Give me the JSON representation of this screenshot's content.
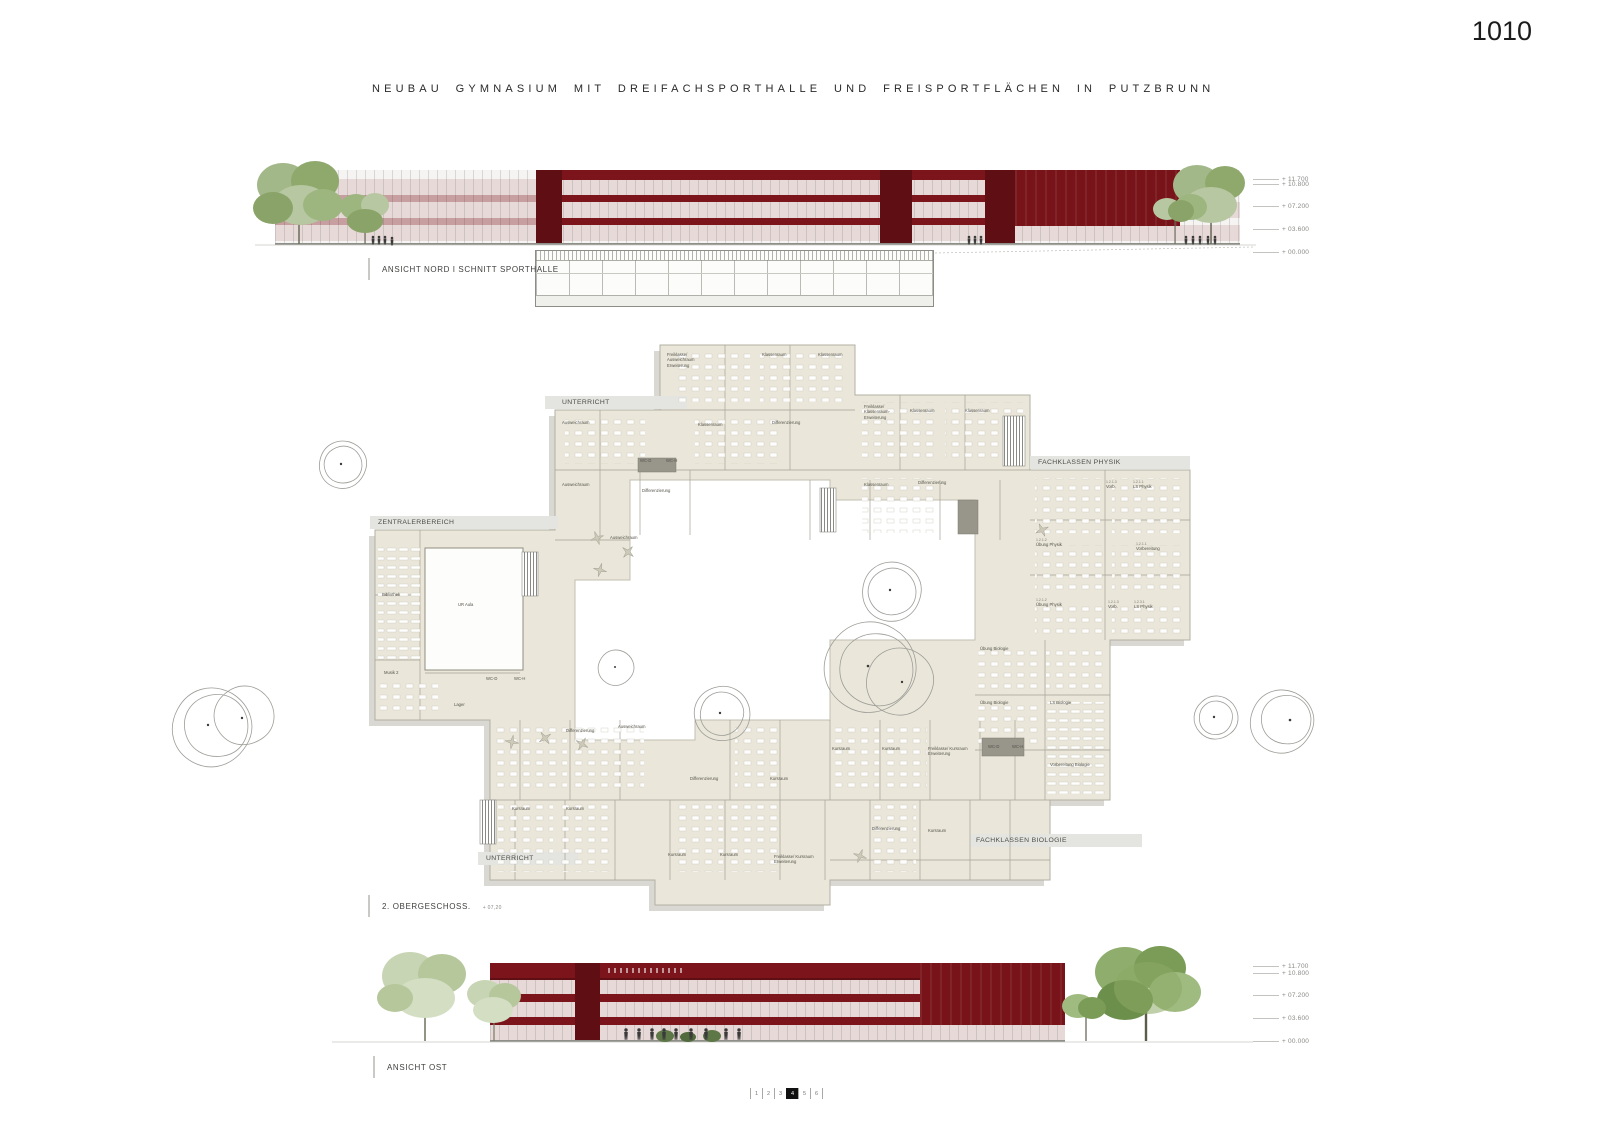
{
  "sheet": {
    "number": "1010"
  },
  "title": "NEUBAU  GYMNASIUM MIT DREIFACHSPORTHALLE UND FREISPORTFLÄCHEN IN PUTZBRUNN",
  "labels": {
    "north": "ANSICHT NORD I SCHNITT SPORTHALLE",
    "east": "ANSICHT OST",
    "floor": "2. OBERGESCHOSS.",
    "floor_level": "+ 07,20"
  },
  "levels": [
    "+ 11.700",
    "+ 10.800",
    "+ 07.200",
    "+ 03.600",
    "+ 00.000"
  ],
  "floor_plan": {
    "zones": [
      {
        "n": "UNTERRICHT",
        "x": 392,
        "y": 69
      },
      {
        "n": "ZENTRALERBEREICH",
        "x": 208,
        "y": 189
      },
      {
        "n": "FACHKLASSEN PHYSIK",
        "x": 868,
        "y": 129
      },
      {
        "n": "FACHKLASSEN BIOLOGIE",
        "x": 806,
        "y": 507
      },
      {
        "n": "UNTERRICHT",
        "x": 316,
        "y": 525
      }
    ],
    "rooms": [
      {
        "n": "Freiklasse/ Ausweichraum Erweiterung",
        "x": 497,
        "y": 22
      },
      {
        "n": "Klassenraum",
        "x": 592,
        "y": 22
      },
      {
        "n": "Klassenraum",
        "x": 648,
        "y": 22
      },
      {
        "n": "Ausweichraum",
        "x": 392,
        "y": 90
      },
      {
        "n": "Klassenraum",
        "x": 528,
        "y": 92
      },
      {
        "n": "Differenzierung",
        "x": 602,
        "y": 90
      },
      {
        "n": "Freiklasse/ Klassenraum-Erweiterung",
        "x": 694,
        "y": 74
      },
      {
        "n": "Klassenraum",
        "x": 740,
        "y": 78
      },
      {
        "n": "Klassenraum",
        "x": 795,
        "y": 78
      },
      {
        "n": "Ausweichraum",
        "x": 392,
        "y": 152
      },
      {
        "n": "WC-D",
        "x": 470,
        "y": 128
      },
      {
        "n": "WC-H",
        "x": 496,
        "y": 128
      },
      {
        "n": "Differenzierung",
        "x": 472,
        "y": 158
      },
      {
        "n": "Klassenraum",
        "x": 694,
        "y": 152
      },
      {
        "n": "Differenzierung",
        "x": 748,
        "y": 150
      },
      {
        "n": "Ausweichraum",
        "x": 440,
        "y": 205
      },
      {
        "c": "1.2.1.3",
        "n": "Vorb.",
        "x": 936,
        "y": 150
      },
      {
        "c": "1.2.1.1",
        "n": "LS Physik",
        "x": 963,
        "y": 150
      },
      {
        "c": "1.2.1.2",
        "n": "Übung Physik",
        "x": 866,
        "y": 208
      },
      {
        "c": "1.2.1.1",
        "n": "Vorbereitung",
        "x": 966,
        "y": 212
      },
      {
        "c": "1.2.1.2",
        "n": "Übung Physik",
        "x": 866,
        "y": 268
      },
      {
        "c": "1.2.1.3",
        "n": "Vorb.",
        "x": 938,
        "y": 270
      },
      {
        "c": "1.2.3.1",
        "n": "LS Physik",
        "x": 964,
        "y": 270
      },
      {
        "n": "Übung Biologie",
        "x": 810,
        "y": 316
      },
      {
        "n": "Übung Biologie",
        "x": 810,
        "y": 370
      },
      {
        "n": "LS Biologie",
        "x": 880,
        "y": 370
      },
      {
        "n": "Vorbereitung Biologie",
        "x": 880,
        "y": 432
      },
      {
        "n": "Bibliothek",
        "x": 212,
        "y": 262
      },
      {
        "n": "UR Aula",
        "x": 288,
        "y": 272
      },
      {
        "n": "Musik 2",
        "x": 214,
        "y": 340
      },
      {
        "n": "Lager",
        "x": 284,
        "y": 372
      },
      {
        "n": "WC-D",
        "x": 316,
        "y": 346
      },
      {
        "n": "WC-H",
        "x": 344,
        "y": 346
      },
      {
        "n": "Differenzierung",
        "x": 396,
        "y": 398
      },
      {
        "n": "Ausweichraum",
        "x": 448,
        "y": 394
      },
      {
        "n": "Kursraum",
        "x": 662,
        "y": 416
      },
      {
        "n": "Kursraum",
        "x": 712,
        "y": 416
      },
      {
        "n": "Freiklasse/ Kursraum Erweiterung",
        "x": 758,
        "y": 416
      },
      {
        "n": "WC-D",
        "x": 818,
        "y": 414
      },
      {
        "n": "WC-H",
        "x": 842,
        "y": 414
      },
      {
        "n": "Differenzierung",
        "x": 520,
        "y": 446
      },
      {
        "n": "Kursraum",
        "x": 600,
        "y": 446
      },
      {
        "n": "Kursraum",
        "x": 342,
        "y": 476
      },
      {
        "n": "Kursraum",
        "x": 396,
        "y": 476
      },
      {
        "n": "Differenzierung",
        "x": 702,
        "y": 496
      },
      {
        "n": "Kursraum",
        "x": 758,
        "y": 498
      },
      {
        "n": "Kursraum",
        "x": 498,
        "y": 522
      },
      {
        "n": "Kursraum",
        "x": 550,
        "y": 522
      },
      {
        "n": "Freiklasse/ Kursraum Erweiterung",
        "x": 604,
        "y": 524
      }
    ]
  },
  "pagination": {
    "items": [
      "1",
      "2",
      "3",
      "4",
      "5",
      "6"
    ],
    "active_index": 3
  },
  "colors": {
    "maroon": "#7b151b",
    "maroon_dark": "#5f0e13",
    "plan_beige": "#eae7da",
    "tree_green": "#93ad74"
  }
}
